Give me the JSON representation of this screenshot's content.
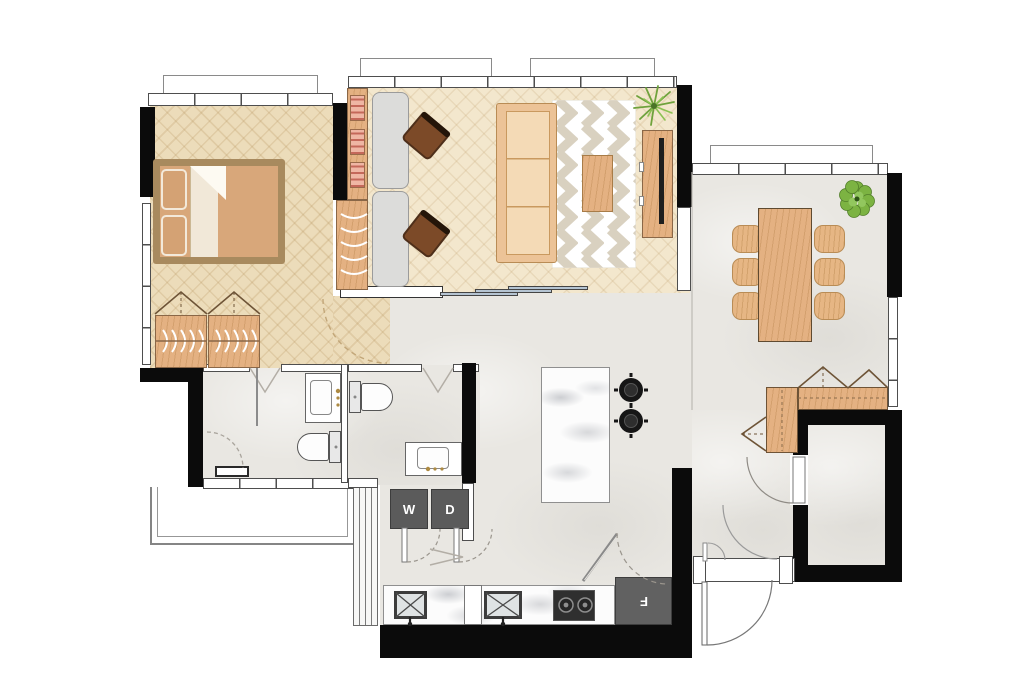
{
  "appliances": {
    "washer": "W",
    "dryer": "D",
    "fridge": "F"
  },
  "colors": {
    "wall_black": "#0b0b0b",
    "wall_line": "#4e4e4e",
    "bedroom_floor": "#ecdcba",
    "living_floor": "#f3e7cd",
    "hard_floor": "#e9e7e2",
    "wood_furniture": "#e4b182",
    "bed_frame": "#a88a5e",
    "mattress": "#d8a77a",
    "sofa": "#ecc397",
    "sofa_seat": "#f4dab6",
    "office_chair": "#7c4a28",
    "desk_gray": "#dcdcda",
    "rug_chevron": "#d9d1c0",
    "plant_green": "#7cb342",
    "appliance_gray": "#5b5b5b",
    "cooktop_black": "#2f2f2f",
    "marble": "#fcfcfc",
    "slider_blue": "#b5c4d2",
    "door_arc_dash": "#b5a27c"
  },
  "icons": {
    "washer": "washer-unit",
    "dryer": "dryer-unit",
    "fridge": "fridge-unit",
    "plants": [
      "spiky-plant",
      "leafy-plant"
    ]
  }
}
